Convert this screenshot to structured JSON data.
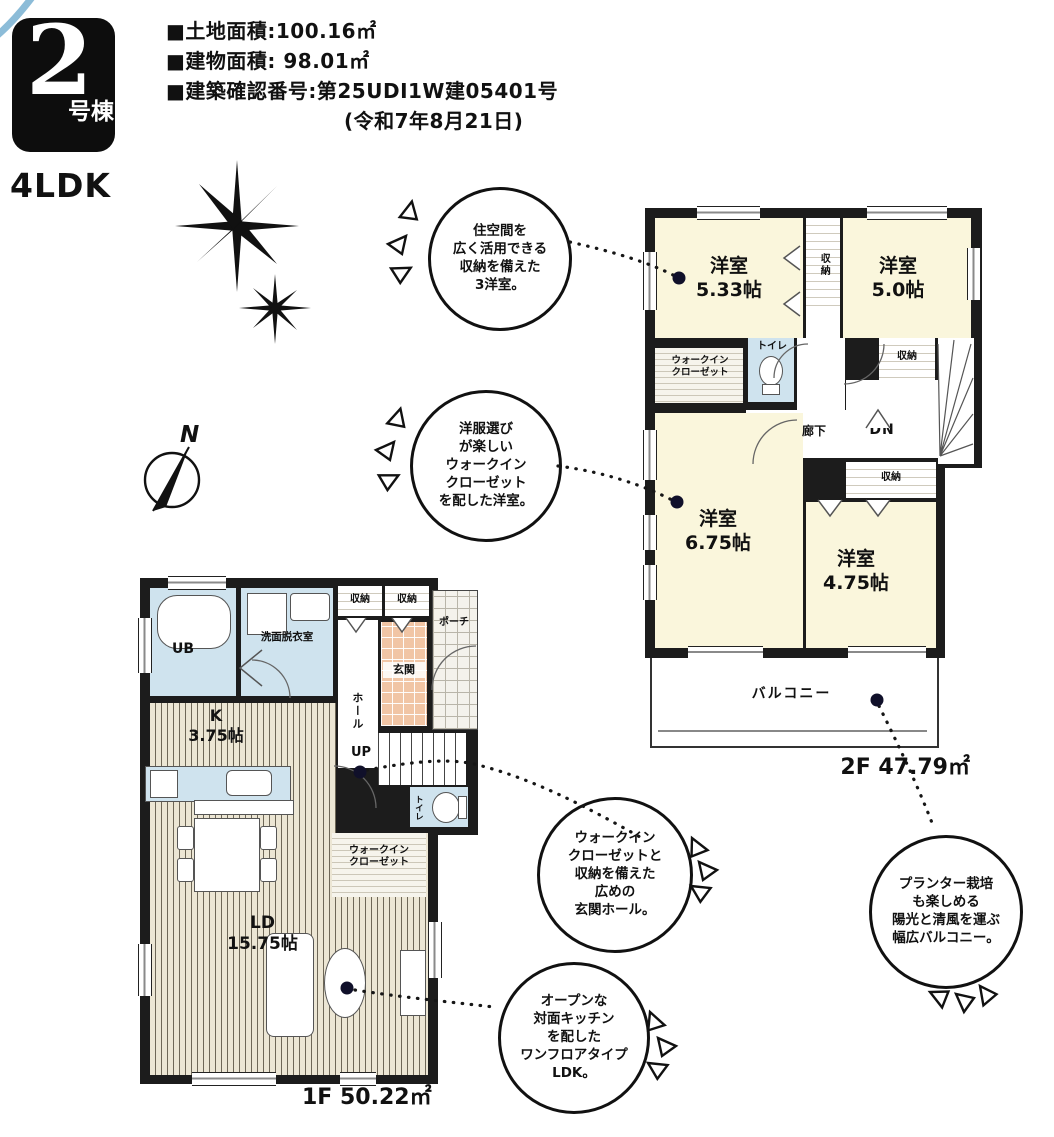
{
  "header": {
    "unit_number": "2",
    "unit_suffix": "号棟",
    "layout_type": "4LDK",
    "land_area_line": "■土地面積:100.16㎡",
    "building_area_line": "■建物面積: 98.01㎡",
    "confirmation_line": "■建築確認番号:第25UDI1W建05401号",
    "confirmation_date_line": "(令和7年8月21日)"
  },
  "compass": {
    "north": "N"
  },
  "callouts": [
    {
      "id": "three-bedrooms",
      "text": "住空間を\n広く活用できる\n収納を備えた\n3洋室。"
    },
    {
      "id": "wic-bedroom",
      "text": "洋服選び\nが楽しい\nウォークイン\nクローゼット\nを配した洋室。"
    },
    {
      "id": "entrance-hall",
      "text": "ウォークイン\nクローゼットと\n収納を備えた\n広めの\n玄関ホール。"
    },
    {
      "id": "one-floor-ldk",
      "text": "オープンな\n対面キッチン\nを配した\nワンフロアタイプ\nLDK。"
    },
    {
      "id": "wide-balcony",
      "text": "プランター栽培\nも楽しめる\n陽光と清風を運ぶ\n幅広バルコニー。"
    }
  ],
  "floor2": {
    "area_label": "2F 47.79㎡",
    "bedroom1_name": "洋室",
    "bedroom1_size": "5.33帖",
    "bedroom2_name": "洋室",
    "bedroom2_size": "5.0帖",
    "bedroom3_name": "洋室",
    "bedroom3_size": "6.75帖",
    "bedroom4_name": "洋室",
    "bedroom4_size": "4.75帖",
    "wic": "ウォークイン\nクローゼット",
    "toilet": "トイレ",
    "hallway": "廊下",
    "stairs_down": "DN",
    "closet_top": "収納",
    "closet_mid": "収納",
    "closet_low": "収納",
    "balcony": "バルコニー"
  },
  "floor1": {
    "area_label": "1F 50.22㎡",
    "bath": "UB",
    "washroom": "洗面脱衣室",
    "closet_a": "収納",
    "closet_b": "収納",
    "entrance": "玄関",
    "porch": "ポーチ",
    "hall": "ホール",
    "kitchen_name": "K",
    "kitchen_size": "3.75帖",
    "stairs_up": "UP",
    "toilet": "トイレ",
    "wic": "ウォークイン\nクローゼット",
    "living_name": "LD",
    "living_size": "15.75帖"
  }
}
